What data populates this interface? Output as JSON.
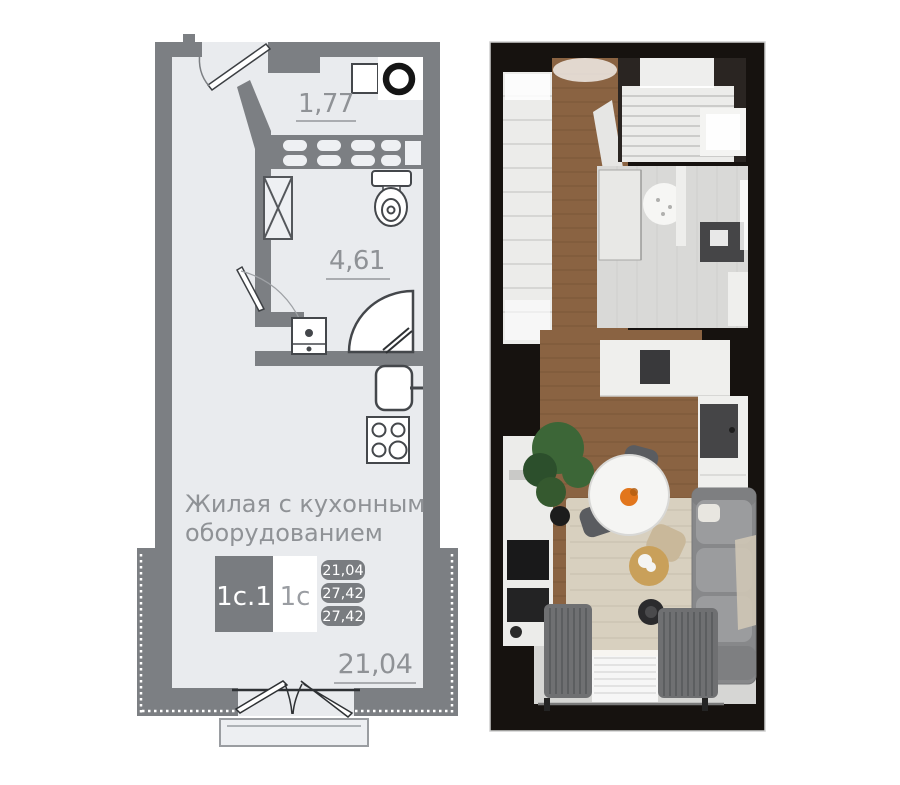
{
  "left_plan": {
    "areas": {
      "hallway": "1,77",
      "bathroom": "4,61",
      "living": "21,04"
    },
    "room_label": [
      "Жилая с кухонным",
      "оборудованием"
    ],
    "unit_badge": {
      "unit": "1с.1",
      "plan_type": "1с",
      "areas": [
        "21,04",
        "27,42",
        "27,42"
      ]
    },
    "fixtures": [
      "entry-door",
      "washbasin",
      "washing-machine",
      "ventilation-shaft",
      "duct-shaft",
      "toilet",
      "sink-cabinet",
      "shower-cabin",
      "kitchen-sink",
      "cooktop",
      "french-window",
      "balcony"
    ],
    "colors": {
      "wall": "#7c7f83",
      "floor": "#e9ebee",
      "outline": "#54575b",
      "text": "#8f9296",
      "badge": "#797c80",
      "white": "#ffffff"
    }
  },
  "right_render": {
    "furniture": [
      "wardrobe",
      "shelving-closet",
      "shower",
      "vanity",
      "kitchen-counter",
      "cooktop",
      "kitchen-sink",
      "dining-table",
      "chairs",
      "plant",
      "tv-unit",
      "sofa",
      "rug",
      "armchair",
      "coffee-table",
      "curtains",
      "window"
    ],
    "colors": {
      "wall": "#16120f",
      "wood": "#8a6342",
      "plank": "#6b4a2e",
      "tile": "#d9d9d7",
      "cabinet": "#ececea",
      "counter": "#efefed",
      "sofa": "#87888a",
      "cushion": "#9b9c9e",
      "rug": "#d8d0bf",
      "curtain": "#6f7072",
      "plant": "#3c6637",
      "chair_dark": "#5a5c60",
      "chair_beige": "#c9b89a",
      "table": "#f5f5f3",
      "fruit": "#e2761c",
      "dark_fixture": "#454547"
    }
  }
}
